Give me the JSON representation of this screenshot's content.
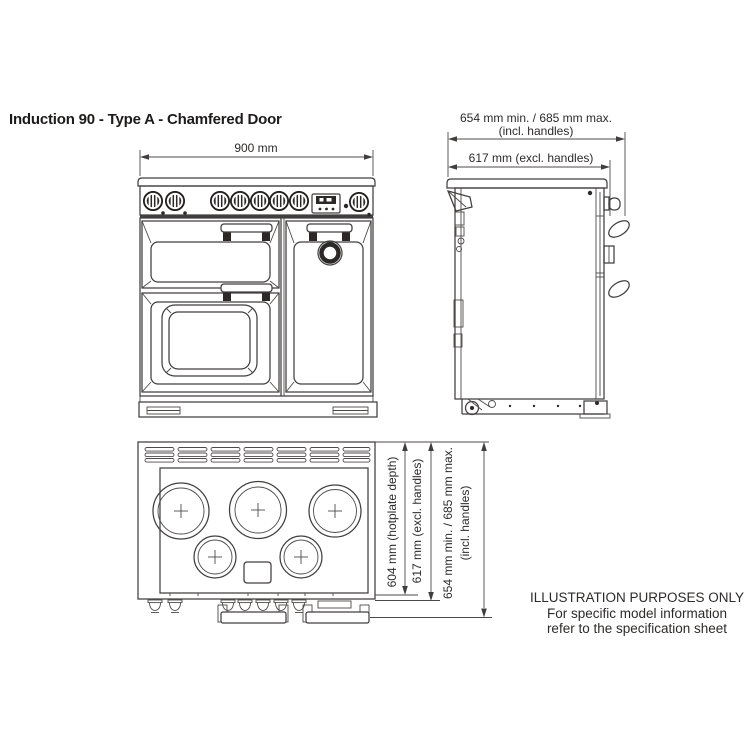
{
  "title": "Induction 90 - Type A - Chamfered Door",
  "dimensions": {
    "width": "900 mm",
    "depth_incl_min_max": "654 mm min. / 685 mm max.",
    "depth_incl_suffix": "(incl. handles)",
    "depth_excl": "617 mm (excl. handles)",
    "hotplate_depth": "604 mm (hotplate depth)"
  },
  "note": {
    "line1": "ILLUSTRATION PURPOSES ONLY",
    "line2": "For specific model information",
    "line3": "refer to the specification sheet"
  },
  "views": {
    "front": "front elevation",
    "side": "side elevation",
    "top": "plan view of hob"
  },
  "hob": {
    "zones": 5,
    "vent_groups": 7
  },
  "colors": {
    "line": "#413f3e",
    "text": "#2d2b2a",
    "background": "#ffffff"
  }
}
